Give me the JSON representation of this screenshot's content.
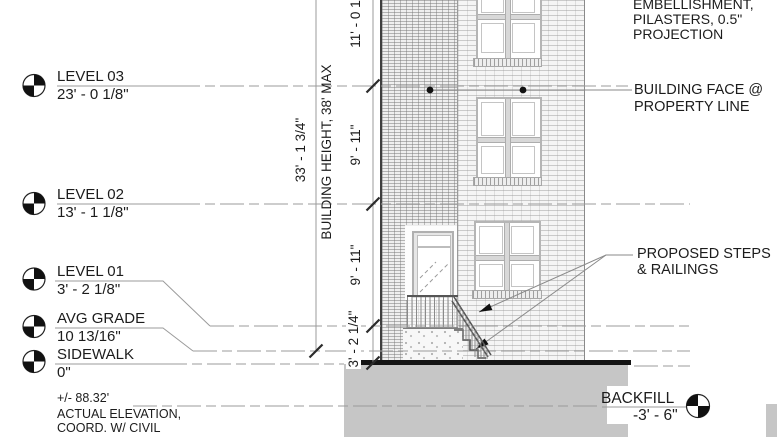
{
  "drawing": {
    "levels": [
      {
        "name": "LEVEL 03",
        "elevation": "23' - 0 1/8\""
      },
      {
        "name": "LEVEL 02",
        "elevation": "13' - 1 1/8\""
      },
      {
        "name": "LEVEL 01",
        "elevation": "3' - 2 1/8\""
      },
      {
        "name": "AVG GRADE",
        "elevation": "10 13/16\""
      },
      {
        "name": "SIDEWALK",
        "elevation": "0\""
      }
    ],
    "civil_note": {
      "line1": "+/- 88.32'",
      "line2": "ACTUAL ELEVATION,",
      "line3": "COORD. W/ CIVIL"
    },
    "dimensions": {
      "overall": "33' - 1 3/4\"",
      "height_note": "BUILDING HEIGHT, 38' MAX",
      "seg_top": "11' - 0 1/4\"",
      "seg_l3_l2": "9' - 11\"",
      "seg_l2_l1": "9' - 11\"",
      "seg_l1_sw": "3' - 2 1/4\""
    },
    "callouts": {
      "embellishment": {
        "line1": "EMBELLISHMENT,",
        "line2": "PILASTERS, 0.5\"",
        "line3": "PROJECTION"
      },
      "building_face": {
        "line1": "BUILDING FACE @",
        "line2": "PROPERTY LINE"
      },
      "steps": {
        "line1": "PROPOSED STEPS",
        "line2": "& RAILINGS"
      },
      "backfill": {
        "name": "BACKFILL",
        "elevation": "-3' - 6\""
      }
    },
    "colors": {
      "line_gray": "#999999",
      "text_black": "#1c1c1c",
      "backfill_gray": "#c6c6c6",
      "ground_black": "#141414"
    }
  }
}
